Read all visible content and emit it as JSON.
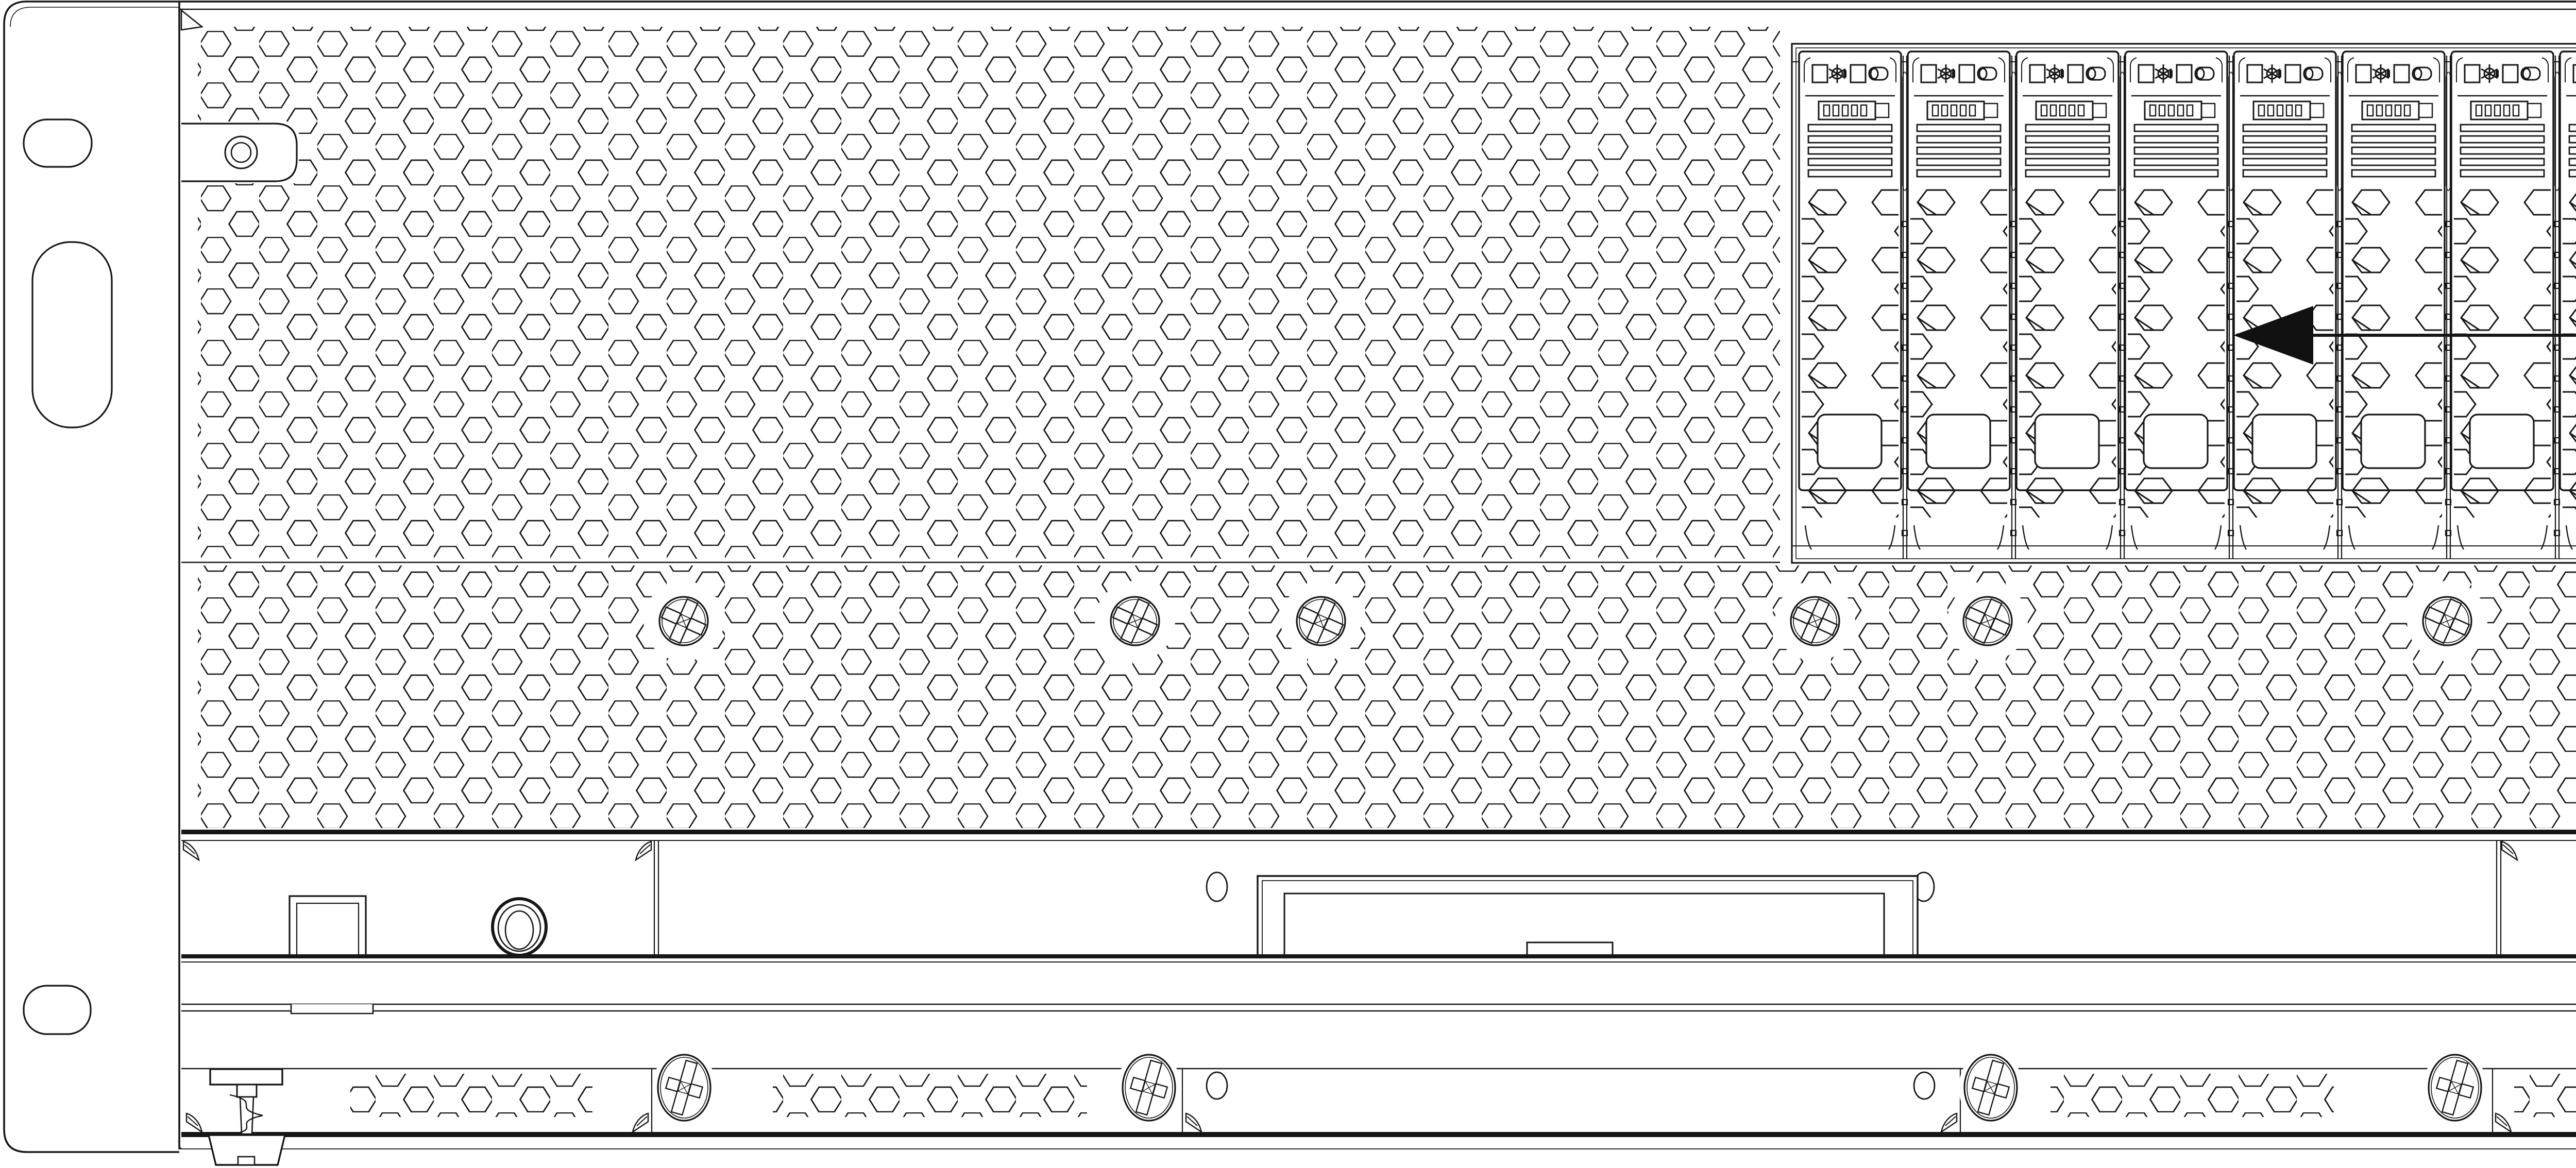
{
  "title": "Rack server front panel line diagram",
  "labels": {
    "drive_caddies": "Drive Caddies",
    "fan_cover": "Fan Cover",
    "filter_housing_line1": "Filter Housing in",
    "filter_housing_line2": "Down Position"
  },
  "components": {
    "drive_caddy_count": 8,
    "fan_cover_screw_count": 6,
    "bottom_panel_screw_count": 4,
    "rack_ear_count": 2,
    "leveling_foot_count": 2
  },
  "icons": {
    "caddy_icons": [
      "status-square",
      "activity-led-star",
      "status-square",
      "power-led-pill"
    ],
    "screw_icon": "phillips-screw",
    "arrow_icon": "solid-left-arrowhead"
  },
  "colors": {
    "line": "#161616",
    "label_text": "#141414",
    "background": "#ffffff",
    "arrow_fill": "#111111"
  }
}
